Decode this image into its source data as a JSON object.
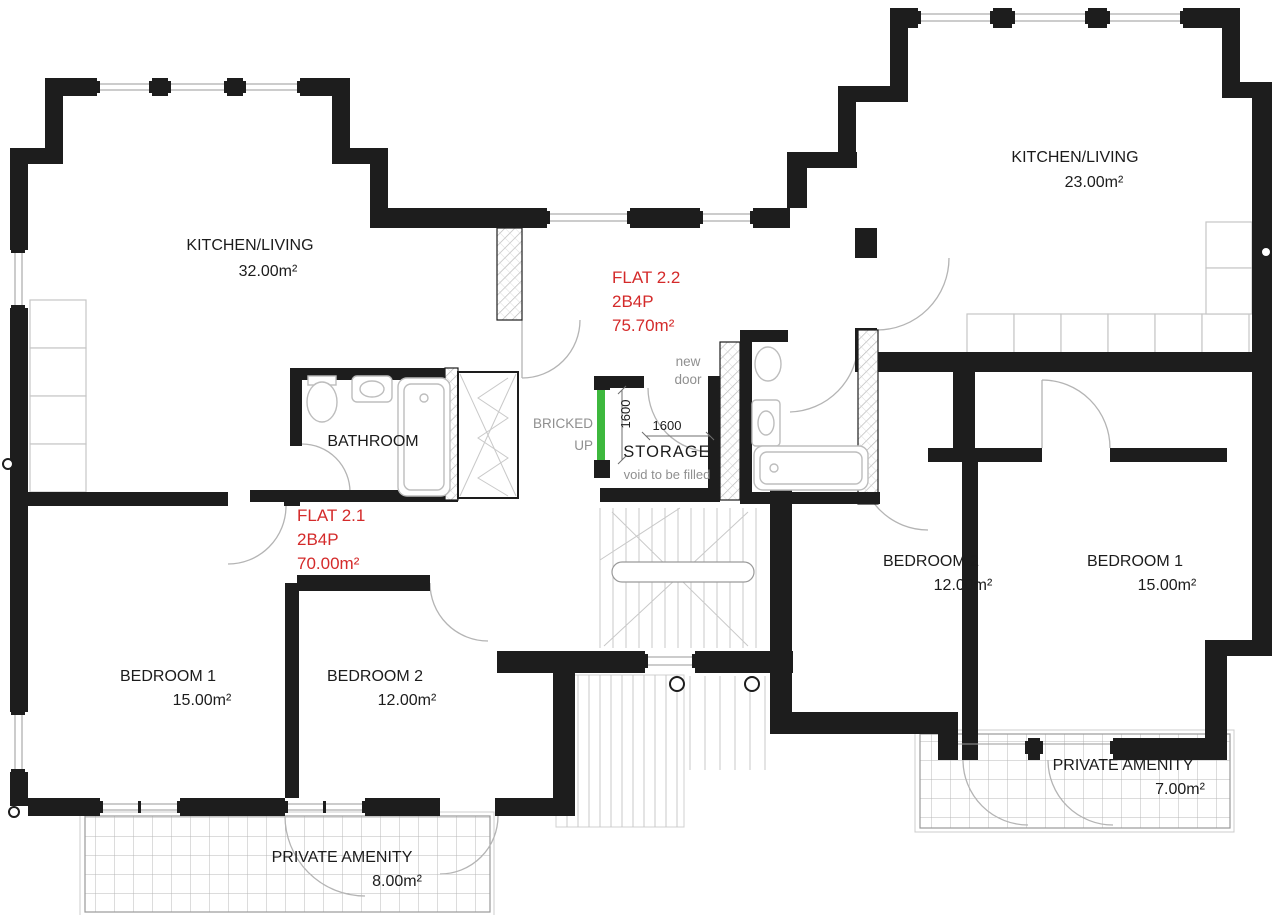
{
  "colors": {
    "wall_black": "#1d1d1d",
    "flat_label_red": "#d42a2a",
    "annotation_gray": "#8f8f8f",
    "new_wall_green": "#3db83d"
  },
  "flat_2_1": {
    "label": "FLAT 2.1",
    "occupancy": "2B4P",
    "area": "70.00m²",
    "kitchen_living": {
      "name": "KITCHEN/LIVING",
      "area": "32.00m²"
    },
    "bathroom": {
      "name": "BATHROOM"
    },
    "bedroom_1": {
      "name": "BEDROOM 1",
      "area": "15.00m²"
    },
    "bedroom_2": {
      "name": "BEDROOM 2",
      "area": "12.00m²"
    },
    "private_amenity": {
      "name": "PRIVATE AMENITY",
      "area": "8.00m²"
    }
  },
  "flat_2_2": {
    "label": "FLAT 2.2",
    "occupancy": "2B4P",
    "area": "75.70m²",
    "kitchen_living": {
      "name": "KITCHEN/LIVING",
      "area": "23.00m²"
    },
    "bedroom_1": {
      "name": "BEDROOM 1",
      "area": "15.00m²"
    },
    "bedroom_2": {
      "name": "BEDROOM 2",
      "area": "12.00m²"
    },
    "private_amenity": {
      "name": "PRIVATE AMENITY",
      "area": "7.00m²"
    }
  },
  "storage": {
    "name": "STORAGE",
    "note": "void to be filled",
    "width_dim": "1600",
    "depth_dim": "1600"
  },
  "annotations": {
    "new_door_line_1": "new",
    "new_door_line_2": "door",
    "bricked_up_line_1": "BRICKED",
    "bricked_up_line_2": "UP"
  }
}
